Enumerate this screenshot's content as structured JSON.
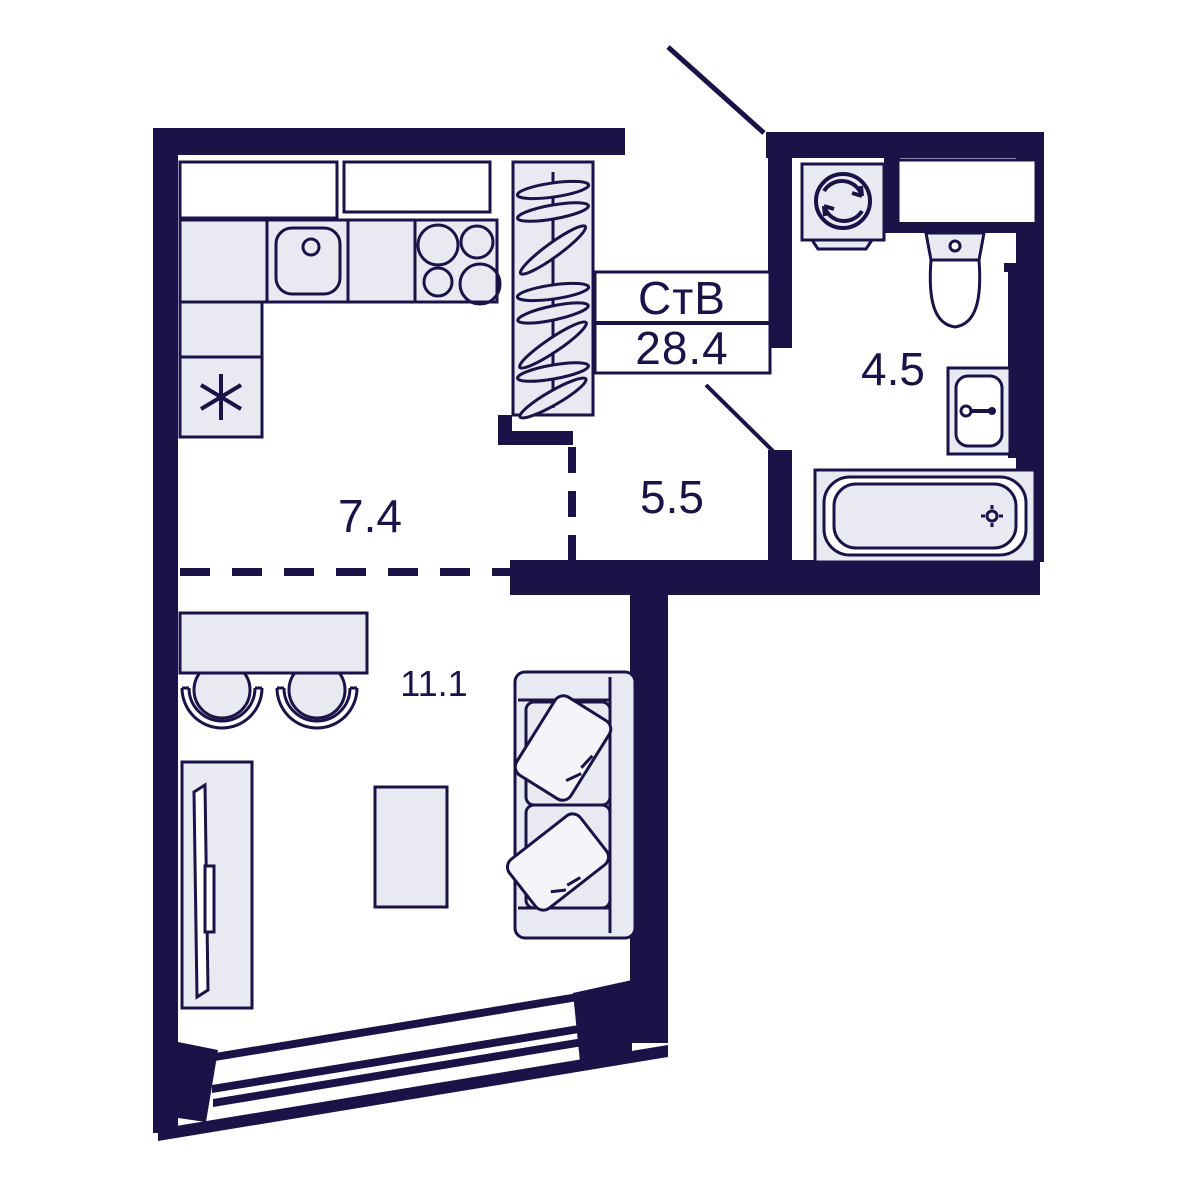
{
  "plan": {
    "title_box": {
      "type_label": "СтВ",
      "area_value": "28.4"
    },
    "rooms": [
      {
        "name": "kitchen",
        "area": "7.4"
      },
      {
        "name": "hallway",
        "area": "5.5"
      },
      {
        "name": "bathroom",
        "area": "4.5"
      },
      {
        "name": "living-room",
        "area": "11.1"
      }
    ],
    "colors": {
      "wall": "#1b1347",
      "fixture": "#e9e9f2",
      "pillow": "#f4f4f9",
      "background": "#ffffff"
    }
  }
}
